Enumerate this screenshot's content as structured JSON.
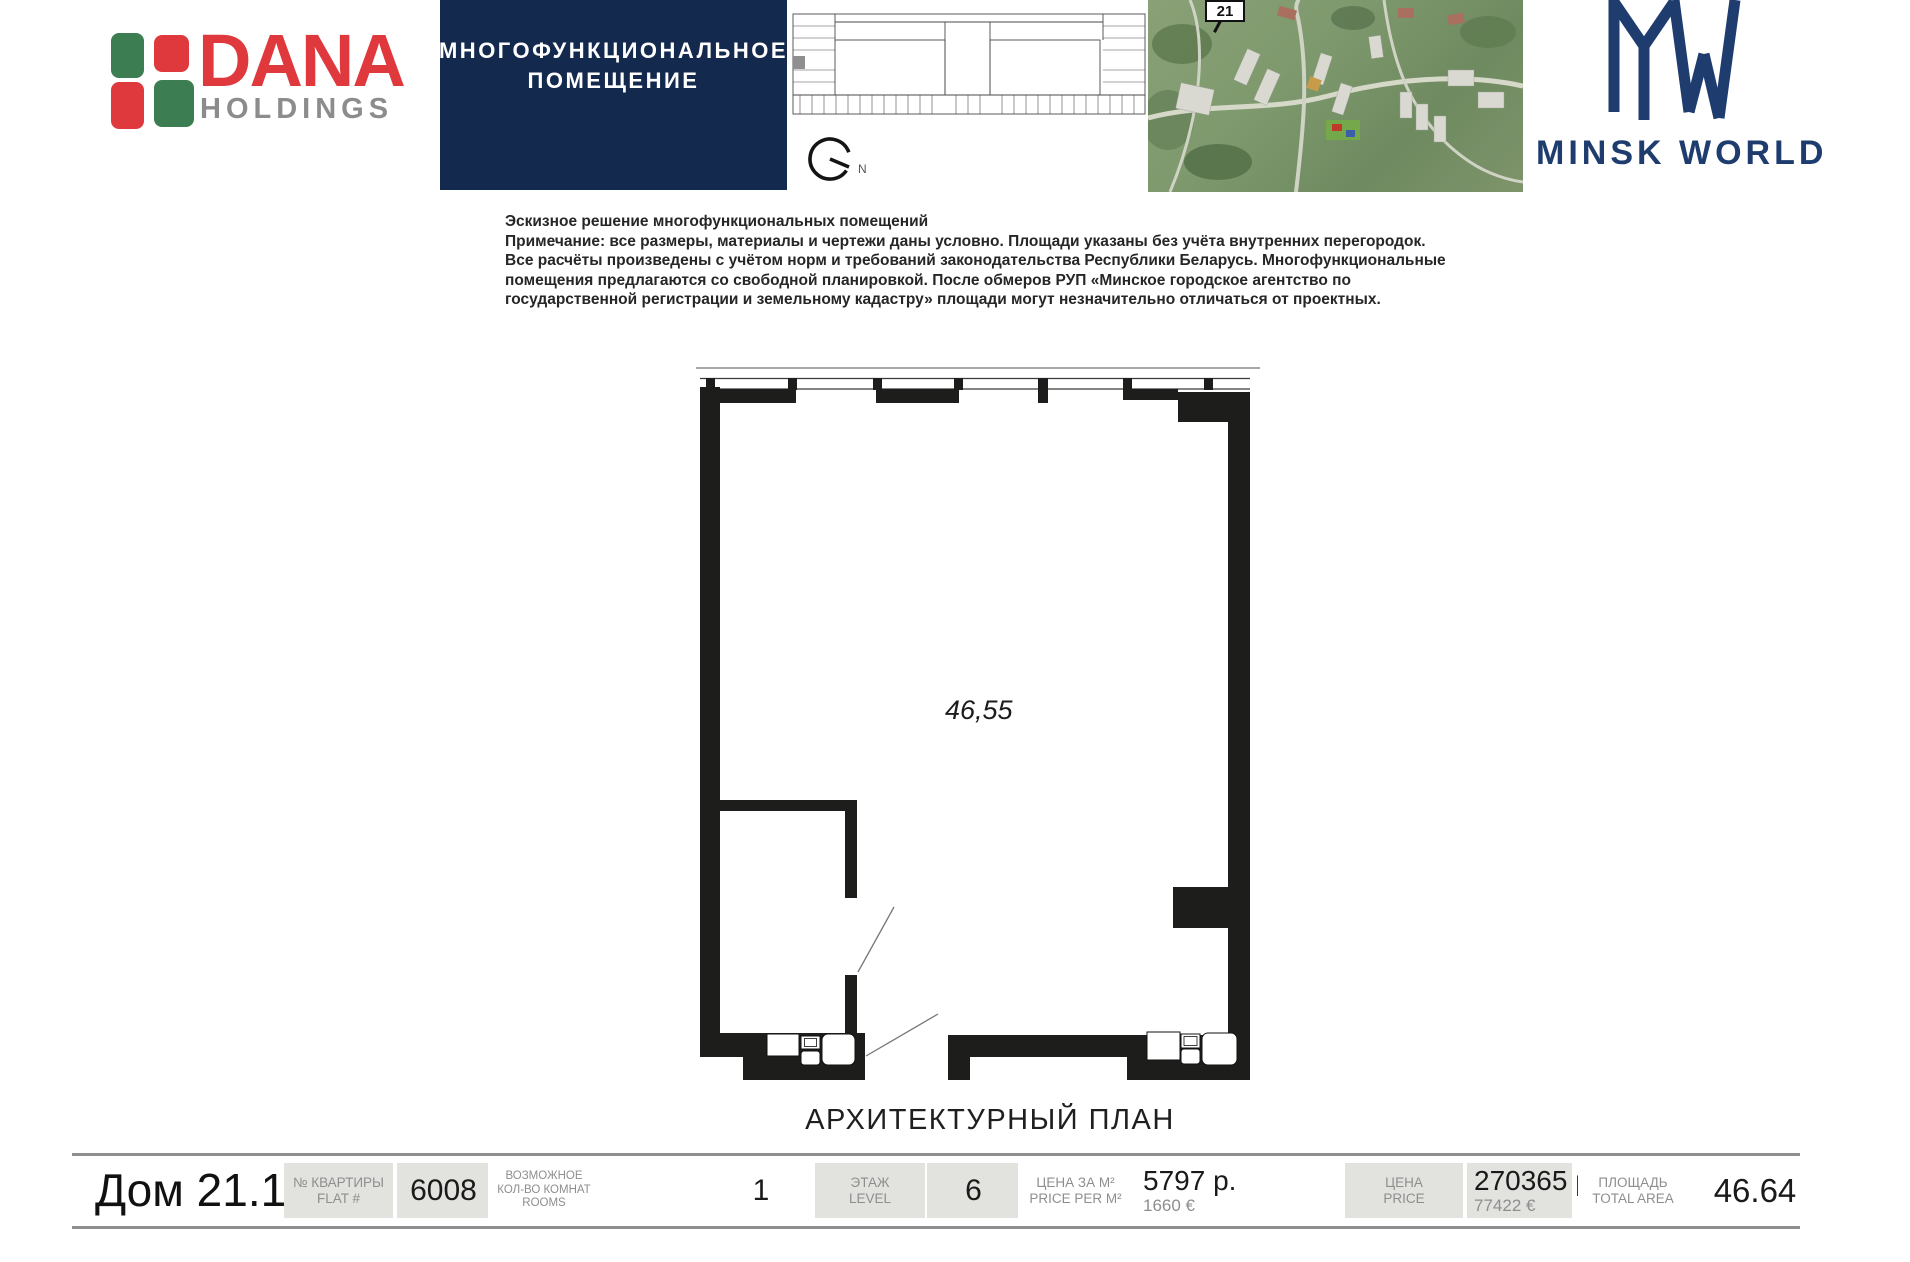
{
  "branding": {
    "dana": {
      "name": "DANA",
      "sub": "HOLDINGS"
    },
    "minsk_world": {
      "title": "MINSK WORLD"
    }
  },
  "header": {
    "unit_type_line1": "МНОГОФУНКЦИОНАЛЬНОЕ",
    "unit_type_line2": "ПОМЕЩЕНИЕ",
    "building_badge": "21",
    "compass_label": "N"
  },
  "disclaimer": {
    "lines": [
      "Эскизное решение многофункциональных помещений",
      "Примечание: все размеры, материалы и чертежи даны условно. Площади указаны без учёта внутренних перегородок.",
      "Все расчёты произведены с учётом норм и требований законодательства Республики Беларусь. Многофункциональные",
      "помещения предлагаются со свободной планировкой. После обмеров РУП «Минское городское агентство по",
      "государственной регистрации и земельному кадастру» площади могут незначительно отличаться от проектных."
    ]
  },
  "plan": {
    "area_label": "46,55",
    "caption": "АРХИТЕКТУРНЫЙ ПЛАН"
  },
  "bar": {
    "house": "Дом 21.1",
    "flat": {
      "label1": "№ КВАРТИРЫ",
      "label2": "FLAT #",
      "value": "6008"
    },
    "rooms": {
      "label1": "ВОЗМОЖНОЕ",
      "label2": "КОЛ-ВО КОМНАТ",
      "label3": "ROOMS",
      "value": "1"
    },
    "level": {
      "label1": "ЭТАЖ",
      "label2": "LEVEL",
      "value": "6"
    },
    "price_per_m2": {
      "label1": "ЦЕНА ЗА М²",
      "label2": "PRICE PER M²",
      "value_byn": "5797 р.",
      "value_eur": "1660 €"
    },
    "price": {
      "label1": "ЦЕНА",
      "label2": "PRICE",
      "value_byn": "270365 р.",
      "value_eur": "77422 €"
    },
    "area": {
      "label1": "ПЛОЩАДЬ",
      "label2": "TOTAL AREA",
      "value": "46.64"
    }
  },
  "colors": {
    "header_navy": "#14294e",
    "brand_navy": "#1e3c6e",
    "dana_green": "#3c7d52",
    "dana_red": "#e0393d",
    "label_gray": "#8e8e8e",
    "box_gray": "#e2e2df",
    "wall_black": "#1d1d1b"
  }
}
